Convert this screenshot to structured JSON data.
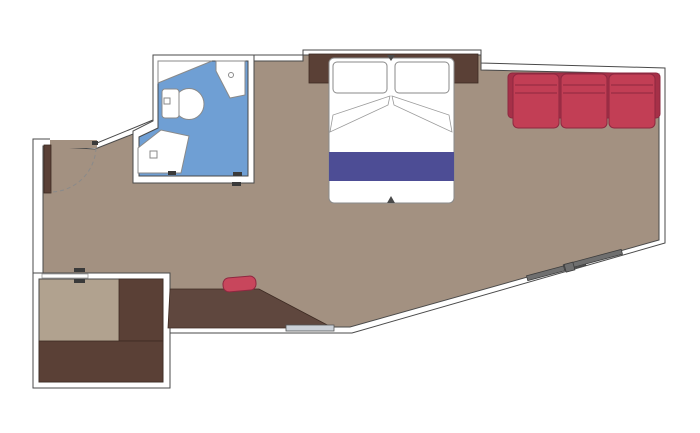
{
  "diagram": {
    "kind": "cabin-floor-plan",
    "rooms": [
      {
        "name": "main-cabin"
      },
      {
        "name": "bathroom"
      },
      {
        "name": "balcony-room"
      }
    ],
    "furniture": [
      "entrance-door",
      "double-bed",
      "pillow-left",
      "pillow-right",
      "bed-runner",
      "headboard",
      "sofa-3-seat",
      "desk",
      "desk-chair",
      "toilet",
      "corner-shower",
      "vanity-washbasin",
      "counter-shelf",
      "balcony-bench-side",
      "balcony-bench-bottom",
      "sliding-door",
      "threshold-bar"
    ]
  },
  "colors": {
    "exterior": "#ffffff",
    "wall": "#ffffff",
    "outline": "#4a4a4a",
    "cabin_floor": "#a39181",
    "balcony_floor": "#b1a28f",
    "bathroom_floor": "#6f9fd4",
    "wood_dark": "#5a4036",
    "desk_wood": "#5f473e",
    "sofa_red": "#c23e55",
    "sofa_red_dark": "#a63048",
    "chair_red": "#c8465c",
    "runner_blue": "#4d4d95",
    "fixture_fill": "#ffffff",
    "slat_gray": "#6f6f6f",
    "threshold_gray": "#ccd1d8",
    "mark_dark": "#3a3a3a",
    "arc_gray": "#8a8a8a",
    "notch_dark": "#4a4a4a"
  }
}
